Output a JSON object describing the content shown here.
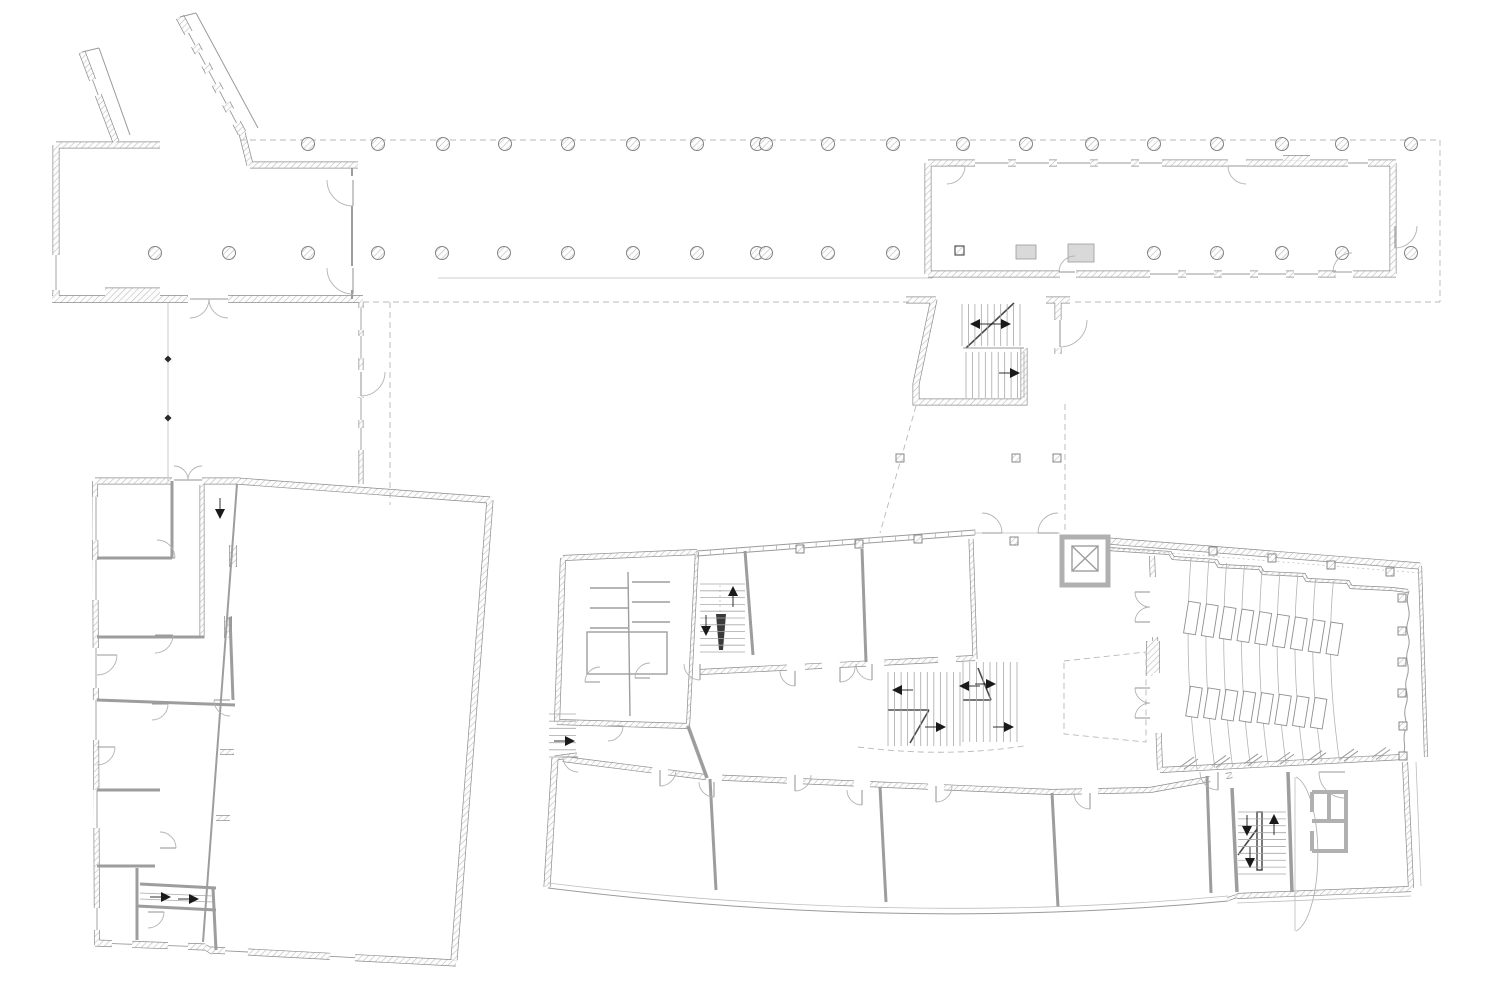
{
  "drawing": {
    "width": 1500,
    "height": 1000,
    "background": "#ffffff",
    "type": "architectural-floor-plan",
    "description": "Ground floor plan: entrance pavilion with colonnade walkway, long north-east wing, stair link, rotated west building and polygonal main building with auditorium"
  },
  "palette": {
    "wall_edge": "#8c8c8c",
    "hatch_line": "#b9b9b9",
    "partition": "#9d9d9d",
    "thin_line": "#9a9a9a",
    "dash_line": "#b8b8b8",
    "gray_wall": "#b0b0b0",
    "arrow": "#1a1a1a",
    "background": "#ffffff"
  },
  "columns": {
    "radius": 6.5,
    "top_row_y": 144,
    "top_row_x": [
      308,
      378,
      443,
      505,
      568,
      633,
      697,
      757,
      766,
      828,
      893,
      963,
      1026,
      1092,
      1154,
      1217,
      1282,
      1342,
      1411
    ],
    "bottom_row_y": 253,
    "bottom_row_x": [
      155,
      229,
      308,
      378,
      442,
      504,
      568,
      633,
      697,
      757,
      766,
      828,
      893,
      1154,
      1217,
      1282,
      1342,
      1411
    ]
  },
  "ne_wing": {
    "rect_columns": [
      {
        "x": 1016,
        "y": 245,
        "w": 20,
        "h": 14
      },
      {
        "x": 1068,
        "y": 244,
        "w": 26,
        "h": 18
      }
    ],
    "dark_square": {
      "x": 955,
      "y": 246,
      "s": 9
    }
  },
  "posts": {
    "curtain": [
      [
        800,
        549
      ],
      [
        859,
        544
      ],
      [
        918,
        539
      ]
    ],
    "aud_north": [
      [
        1213,
        551
      ],
      [
        1272,
        558
      ],
      [
        1331,
        565
      ],
      [
        1390,
        572
      ]
    ],
    "aud_east": [
      [
        1402,
        598
      ],
      [
        1402,
        631
      ],
      [
        1402,
        662
      ],
      [
        1402,
        693
      ],
      [
        1403,
        726
      ],
      [
        1403,
        756
      ]
    ],
    "link_row": [
      [
        900,
        458
      ],
      [
        1016,
        458
      ],
      [
        1057,
        458
      ]
    ],
    "entry": [
      [
        1014,
        541
      ]
    ],
    "size": 8
  },
  "mullions": [
    [
      565,
      888
    ],
    [
      629,
      891
    ],
    [
      688,
      895
    ],
    [
      748,
      900
    ],
    [
      807,
      904
    ],
    [
      865,
      908
    ],
    [
      924,
      912
    ],
    [
      983,
      915
    ],
    [
      1042,
      912
    ],
    [
      1102,
      907
    ],
    [
      1160,
      903
    ]
  ],
  "stairs": [
    {
      "x": 962,
      "y": 304,
      "w": 58,
      "h": 42,
      "n": 10,
      "dir": "v"
    },
    {
      "x": 966,
      "y": 352,
      "w": 58,
      "h": 46,
      "n": 10,
      "dir": "v"
    },
    {
      "x": 700,
      "y": 584,
      "w": 45,
      "h": 68,
      "n": 11,
      "dir": "h"
    },
    {
      "x": 888,
      "y": 672,
      "w": 72,
      "h": 74,
      "n": 12,
      "dir": "v"
    },
    {
      "x": 963,
      "y": 662,
      "w": 54,
      "h": 80,
      "n": 9,
      "dir": "v"
    },
    {
      "x": 1238,
      "y": 812,
      "w": 48,
      "h": 62,
      "n": 10,
      "dir": "h"
    },
    {
      "x": 549,
      "y": 714,
      "w": 27,
      "h": 43,
      "n": 7,
      "dir": "h"
    }
  ],
  "arrows": [
    {
      "x": 978,
      "y": 324,
      "d": "l"
    },
    {
      "x": 1003,
      "y": 324,
      "d": "r"
    },
    {
      "x": 1012,
      "y": 373,
      "d": "r"
    },
    {
      "x": 733,
      "y": 594,
      "d": "u"
    },
    {
      "x": 706,
      "y": 628,
      "d": "d"
    },
    {
      "x": 900,
      "y": 690,
      "d": "l"
    },
    {
      "x": 967,
      "y": 686,
      "d": "l"
    },
    {
      "x": 988,
      "y": 684,
      "d": "r"
    },
    {
      "x": 938,
      "y": 727,
      "d": "r"
    },
    {
      "x": 1006,
      "y": 727,
      "d": "r"
    },
    {
      "x": 1247,
      "y": 828,
      "d": "d"
    },
    {
      "x": 1274,
      "y": 822,
      "d": "u"
    },
    {
      "x": 1250,
      "y": 860,
      "d": "d"
    },
    {
      "x": 163,
      "y": 897,
      "d": "r"
    },
    {
      "x": 191,
      "y": 899,
      "d": "r"
    },
    {
      "x": 567,
      "y": 741,
      "d": "r"
    },
    {
      "x": 220,
      "y": 511,
      "d": "d"
    }
  ],
  "doors": [
    {
      "x": 353,
      "y": 180,
      "r": 26,
      "a0": 90,
      "a1": 180
    },
    {
      "x": 353,
      "y": 268,
      "r": 26,
      "a0": 90,
      "a1": 180
    },
    {
      "x": 190,
      "y": 299,
      "r": 19,
      "a0": 0,
      "a1": 90
    },
    {
      "x": 228,
      "y": 299,
      "r": 19,
      "a0": 180,
      "a1": 90
    },
    {
      "x": 174,
      "y": 480,
      "r": 14,
      "a0": 0,
      "a1": -90
    },
    {
      "x": 202,
      "y": 480,
      "r": 14,
      "a0": 180,
      "a1": 270
    },
    {
      "x": 361,
      "y": 372,
      "r": 24,
      "a0": 90,
      "a1": 0
    },
    {
      "x": 947,
      "y": 166,
      "r": 18,
      "a0": 0,
      "a1": 90
    },
    {
      "x": 1246,
      "y": 166,
      "r": 18,
      "a0": 180,
      "a1": 90
    },
    {
      "x": 1075,
      "y": 272,
      "r": 16,
      "a0": 180,
      "a1": 270
    },
    {
      "x": 1352,
      "y": 272,
      "r": 19,
      "a0": 180,
      "a1": 270
    },
    {
      "x": 1395,
      "y": 226,
      "r": 22,
      "a0": 90,
      "a1": 0
    },
    {
      "x": 1060,
      "y": 320,
      "r": 27,
      "a0": 90,
      "a1": 0
    },
    {
      "x": 982,
      "y": 533,
      "r": 20,
      "a0": 0,
      "a1": -90
    },
    {
      "x": 1058,
      "y": 533,
      "r": 20,
      "a0": 180,
      "a1": 270
    },
    {
      "x": 600,
      "y": 682,
      "r": 15,
      "a0": 180,
      "a1": 270
    },
    {
      "x": 650,
      "y": 678,
      "r": 15,
      "a0": 180,
      "a1": 270
    },
    {
      "x": 608,
      "y": 726,
      "r": 15,
      "a0": 0,
      "a1": 90
    },
    {
      "x": 700,
      "y": 664,
      "r": 16,
      "a0": 90,
      "a1": 180
    },
    {
      "x": 795,
      "y": 671,
      "r": 15,
      "a0": 90,
      "a1": 180
    },
    {
      "x": 840,
      "y": 667,
      "r": 15,
      "a0": 90,
      "a1": 0
    },
    {
      "x": 872,
      "y": 664,
      "r": 16,
      "a0": 90,
      "a1": 180
    },
    {
      "x": 1150,
      "y": 592,
      "r": 15,
      "a0": 180,
      "a1": 90
    },
    {
      "x": 1150,
      "y": 622,
      "r": 15,
      "a0": 180,
      "a1": 270
    },
    {
      "x": 1150,
      "y": 688,
      "r": 15,
      "a0": 180,
      "a1": 90
    },
    {
      "x": 1150,
      "y": 718,
      "r": 15,
      "a0": 180,
      "a1": 270
    },
    {
      "x": 660,
      "y": 770,
      "r": 16,
      "a0": 90,
      "a1": 0
    },
    {
      "x": 714,
      "y": 782,
      "r": 15,
      "a0": 90,
      "a1": 180
    },
    {
      "x": 795,
      "y": 775,
      "r": 16,
      "a0": 90,
      "a1": 0
    },
    {
      "x": 862,
      "y": 790,
      "r": 15,
      "a0": 90,
      "a1": 180
    },
    {
      "x": 936,
      "y": 786,
      "r": 16,
      "a0": 90,
      "a1": 0
    },
    {
      "x": 1090,
      "y": 793,
      "r": 16,
      "a0": 90,
      "a1": 180
    },
    {
      "x": 1218,
      "y": 772,
      "r": 18,
      "a0": 90,
      "a1": 180
    },
    {
      "x": 1345,
      "y": 772,
      "r": 26,
      "a0": 180,
      "a1": 90
    },
    {
      "x": 97,
      "y": 655,
      "r": 20,
      "a0": 0,
      "a1": 90
    },
    {
      "x": 157,
      "y": 558,
      "r": 18,
      "a0": 0,
      "a1": -90
    },
    {
      "x": 155,
      "y": 635,
      "r": 18,
      "a0": 0,
      "a1": 90
    },
    {
      "x": 152,
      "y": 704,
      "r": 16,
      "a0": 0,
      "a1": 90
    },
    {
      "x": 230,
      "y": 700,
      "r": 16,
      "a0": 180,
      "a1": 90
    },
    {
      "x": 97,
      "y": 747,
      "r": 18,
      "a0": 0,
      "a1": 90
    },
    {
      "x": 160,
      "y": 848,
      "r": 16,
      "a0": 0,
      "a1": -90
    },
    {
      "x": 148,
      "y": 912,
      "r": 16,
      "a0": 0,
      "a1": 90
    },
    {
      "x": 578,
      "y": 757,
      "r": 15,
      "a0": 180,
      "a1": 90
    }
  ],
  "window_gaps": [
    {
      "p": [
        975,
        163,
        1008,
        163
      ],
      "w": 7.5,
      "cl": 1
    },
    {
      "p": [
        1016,
        163,
        1049,
        163
      ],
      "w": 7.5,
      "cl": 1
    },
    {
      "p": [
        1057,
        163,
        1090,
        163
      ],
      "w": 7.5,
      "cl": 1
    },
    {
      "p": [
        1098,
        163,
        1131,
        163
      ],
      "w": 7.5,
      "cl": 1
    },
    {
      "p": [
        1139,
        163,
        1162,
        163
      ],
      "w": 7.5,
      "cl": 1
    },
    {
      "p": [
        1348,
        163,
        1368,
        163
      ],
      "w": 7.5,
      "cl": 1
    },
    {
      "p": [
        1228,
        163,
        1246,
        163
      ],
      "w": 7.5,
      "cl": 0
    },
    {
      "p": [
        1150,
        274,
        1178,
        274
      ],
      "w": 7.5,
      "cl": 1
    },
    {
      "p": [
        1186,
        274,
        1214,
        274
      ],
      "w": 7.5,
      "cl": 1
    },
    {
      "p": [
        1222,
        274,
        1250,
        274
      ],
      "w": 7.5,
      "cl": 1
    },
    {
      "p": [
        1258,
        274,
        1286,
        274
      ],
      "w": 7.5,
      "cl": 1
    },
    {
      "p": [
        1294,
        274,
        1318,
        274
      ],
      "w": 7.5,
      "cl": 1
    },
    {
      "p": [
        1060,
        274,
        1076,
        274
      ],
      "w": 7.5,
      "cl": 0
    },
    {
      "p": [
        1336,
        274,
        1353,
        274
      ],
      "w": 7.5,
      "cl": 0
    },
    {
      "p": [
        56,
        255,
        56,
        290
      ],
      "w": 7.5,
      "cl": 1
    },
    {
      "p": [
        188.5,
        32.9,
        195.1,
        45.2
      ],
      "w": 9.5,
      "cl": 1
    },
    {
      "p": [
        198.8,
        52.3,
        205.4,
        64.6
      ],
      "w": 9.5,
      "cl": 1
    },
    {
      "p": [
        209.2,
        71.7,
        215.8,
        84.1
      ],
      "w": 9.5,
      "cl": 1
    },
    {
      "p": [
        219.6,
        91.1,
        226.2,
        103.5
      ],
      "w": 9.5,
      "cl": 1
    },
    {
      "p": [
        229.9,
        110.5,
        236.5,
        122.9
      ],
      "w": 9.5,
      "cl": 1
    },
    {
      "p": [
        92.6,
        80,
        98.2,
        95
      ],
      "w": 7.5,
      "cl": 1
    },
    {
      "p": [
        361,
        308,
        361,
        330
      ],
      "w": 5.5,
      "cl": 1
    },
    {
      "p": [
        361,
        336,
        361,
        358
      ],
      "w": 5.5,
      "cl": 1
    },
    {
      "p": [
        361,
        398,
        361,
        420
      ],
      "w": 5.5,
      "cl": 1
    },
    {
      "p": [
        361,
        428,
        361,
        450
      ],
      "w": 5.5,
      "cl": 1
    },
    {
      "p": [
        361,
        370,
        361,
        397
      ],
      "w": 5.5,
      "cl": 0
    },
    {
      "p": [
        96,
        497,
        96,
        540
      ],
      "w": 6.5,
      "cl": 1
    },
    {
      "p": [
        96,
        560,
        96,
        600
      ],
      "w": 6.5,
      "cl": 1
    },
    {
      "p": [
        96,
        648,
        96,
        688
      ],
      "w": 6.5,
      "cl": 1
    },
    {
      "p": [
        96,
        700,
        96,
        740
      ],
      "w": 6.5,
      "cl": 1
    },
    {
      "p": [
        97,
        790,
        97,
        828
      ],
      "w": 6.5,
      "cl": 1
    },
    {
      "p": [
        97,
        908,
        97,
        930
      ],
      "w": 6.5,
      "cl": 1
    },
    {
      "p": [
        112,
        943.6,
        132,
        944.3
      ],
      "w": 7.5,
      "cl": 1
    },
    {
      "p": [
        168,
        945.6,
        188,
        946.3
      ],
      "w": 7.5,
      "cl": 1
    },
    {
      "p": [
        225,
        950.8,
        248,
        952
      ],
      "w": 7.5,
      "cl": 1
    },
    {
      "p": [
        330,
        956.3,
        355,
        957.7
      ],
      "w": 7.5,
      "cl": 1
    },
    {
      "p": [
        787,
        667.6,
        805,
        666.7
      ],
      "w": 6.5,
      "cl": 0
    },
    {
      "p": [
        822,
        665.8,
        840,
        664.9
      ],
      "w": 6.5,
      "cl": 0
    },
    {
      "p": [
        866,
        663.6,
        884,
        662.6
      ],
      "w": 6.5,
      "cl": 0
    },
    {
      "p": [
        938,
        659.9,
        956,
        659
      ],
      "w": 6.5,
      "cl": 0
    },
    {
      "p": [
        652,
        770.3,
        668,
        772.3
      ],
      "w": 6.5,
      "cl": 0
    },
    {
      "p": [
        706,
        777.1,
        722,
        777.8
      ],
      "w": 6.5,
      "cl": 0
    },
    {
      "p": [
        787,
        780.5,
        803,
        781.2
      ],
      "w": 6.5,
      "cl": 0
    },
    {
      "p": [
        854,
        783.4,
        870,
        784.1
      ],
      "w": 6.5,
      "cl": 0
    },
    {
      "p": [
        928,
        786.6,
        944,
        787.3
      ],
      "w": 6.5,
      "cl": 0
    },
    {
      "p": [
        1082,
        791.4,
        1098,
        791.2
      ],
      "w": 6.5,
      "cl": 0
    },
    {
      "p": [
        1210,
        779,
        1226,
        776.1
      ],
      "w": 6.5,
      "cl": 0
    },
    {
      "p": [
        172,
        481,
        202,
        481
      ],
      "w": 7.5,
      "cl": 0
    },
    {
      "p": [
        137,
        558,
        157,
        558
      ],
      "w": 3.5,
      "cl": 0
    },
    {
      "p": [
        130,
        637,
        152,
        637
      ],
      "w": 3.5,
      "cl": 0
    },
    {
      "p": [
        136,
        702,
        154,
        703
      ],
      "w": 3.5,
      "cl": 0
    },
    {
      "p": [
        214,
        704,
        232,
        705
      ],
      "w": 3.5,
      "cl": 0
    },
    {
      "p": [
        1152.8,
        577,
        1155,
        637
      ],
      "w": 6.5,
      "cl": 0
    },
    {
      "p": [
        1156.4,
        673,
        1158.6,
        733
      ],
      "w": 6.5,
      "cl": 0
    }
  ],
  "auditorium": {
    "rows": 9,
    "row_x0": 1191,
    "row_dx": 17.8,
    "row_top_y0": 557,
    "row_top_dy": 3.0,
    "row_bot_y0": 769,
    "row_bot_dy": -1.1,
    "bulge": -8,
    "mid_y": 663,
    "desks_upper": {
      "count": 9,
      "cx0": 1192,
      "dx": 17.8,
      "cy0": 618,
      "dy": 2.6,
      "w": 12,
      "h": 32,
      "angle": 9
    },
    "desks_lower": {
      "count": 8,
      "cx0": 1194,
      "dx": 17.8,
      "cy0": 702,
      "dy": 1.6,
      "w": 12,
      "h": 30,
      "angle": 9
    }
  },
  "zigzag_windows": {
    "xs": [
      1180,
      1212,
      1244,
      1276,
      1308,
      1340,
      1372
    ],
    "x0": 1160,
    "y0": 770,
    "slope": -0.0496
  },
  "curtain_ticks": {
    "x1": 697,
    "y1": 556,
    "x2": 975,
    "y2": 535,
    "offset": -5,
    "count": 21
  },
  "boundary_markers": [
    [
      168,
      359
    ],
    [
      168,
      418
    ]
  ],
  "ramp_lines": [
    [
      140,
      893,
      213,
      896
    ],
    [
      140,
      899,
      213,
      902
    ]
  ]
}
